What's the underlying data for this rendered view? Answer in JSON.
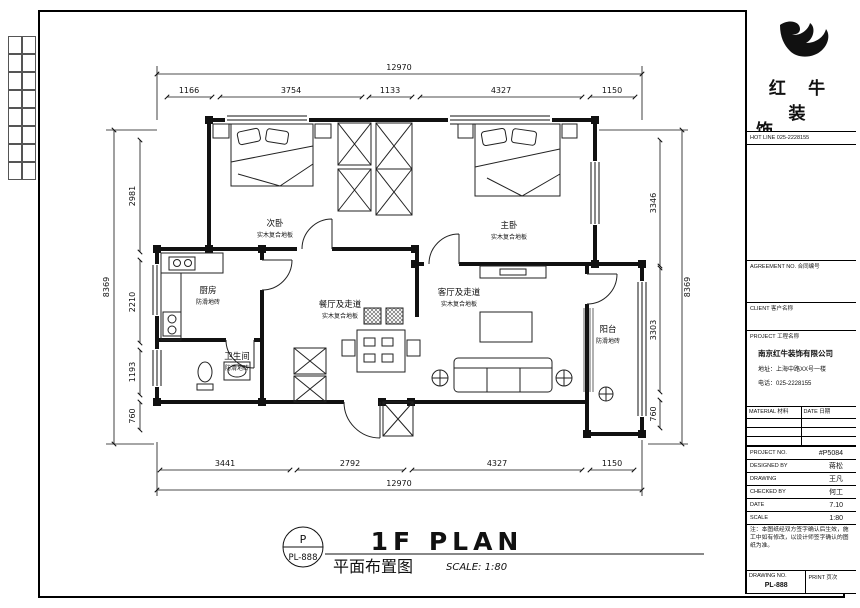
{
  "sheet": {
    "stamp_letter": "P",
    "stamp_number": "PL-888",
    "title_en": "1F PLAN",
    "title_cn": "平面布置图",
    "scale": "SCALE: 1:80"
  },
  "rooms": [
    {
      "name": "次卧",
      "floor": "实木复合地板"
    },
    {
      "name": "主卧",
      "floor": "实木复合地板"
    },
    {
      "name": "厨房",
      "floor": "防滑地砖"
    },
    {
      "name": "餐厅及走道",
      "floor": "实木复合地板"
    },
    {
      "name": "客厅及走道",
      "floor": "实木复合地板"
    },
    {
      "name": "卫生间",
      "floor": "防滑地砖"
    },
    {
      "name": "阳台",
      "floor": "防滑地砖"
    }
  ],
  "dims": {
    "top_total": "12970",
    "top": [
      "1166",
      "3754",
      "1133",
      "4327",
      "1150"
    ],
    "bottom": [
      "3441",
      "2792",
      "4327",
      "1150"
    ],
    "bottom_total": "12970",
    "left": [
      "2981",
      "2210",
      "1193",
      "760"
    ],
    "left_total": "8369",
    "right": [
      "3346",
      "3303",
      "760"
    ],
    "right_total": "8369"
  },
  "titleblock": {
    "brand_line1": "红 牛 装",
    "brand_line2": "饰",
    "hotline": "HOT LINE 025-2228155",
    "section_labels": [
      "AGREEMENT NO. 合同编号",
      "CLIENT 客户名称",
      "PROJECT 工程名称"
    ],
    "company": [
      "南京红牛装饰有限公司",
      "地址：上海中路XX号一楼",
      "电话：025-2228155"
    ],
    "table_headers": [
      "MATERIAL 材料",
      "DATE 日期"
    ],
    "info_rows": [
      {
        "label": "PROJECT NO.",
        "value": "#P5084"
      },
      {
        "label": "DESIGNED BY",
        "value": "蒋松"
      },
      {
        "label": "DRAWING",
        "value": "王凡"
      },
      {
        "label": "CHECKED BY",
        "value": "何工"
      },
      {
        "label": "DATE",
        "value": "7.10"
      },
      {
        "label": "SCALE",
        "value": "1:80"
      }
    ],
    "note": "注：本图纸经双方签字确认后生效，施工中如有修改，以设计师签字确认的图纸为准。",
    "bottom_left_label": "DRAWING NO.",
    "bottom_left_value": "PL-888",
    "bottom_right_label": "PRINT 页次",
    "bottom_right_value": ""
  }
}
